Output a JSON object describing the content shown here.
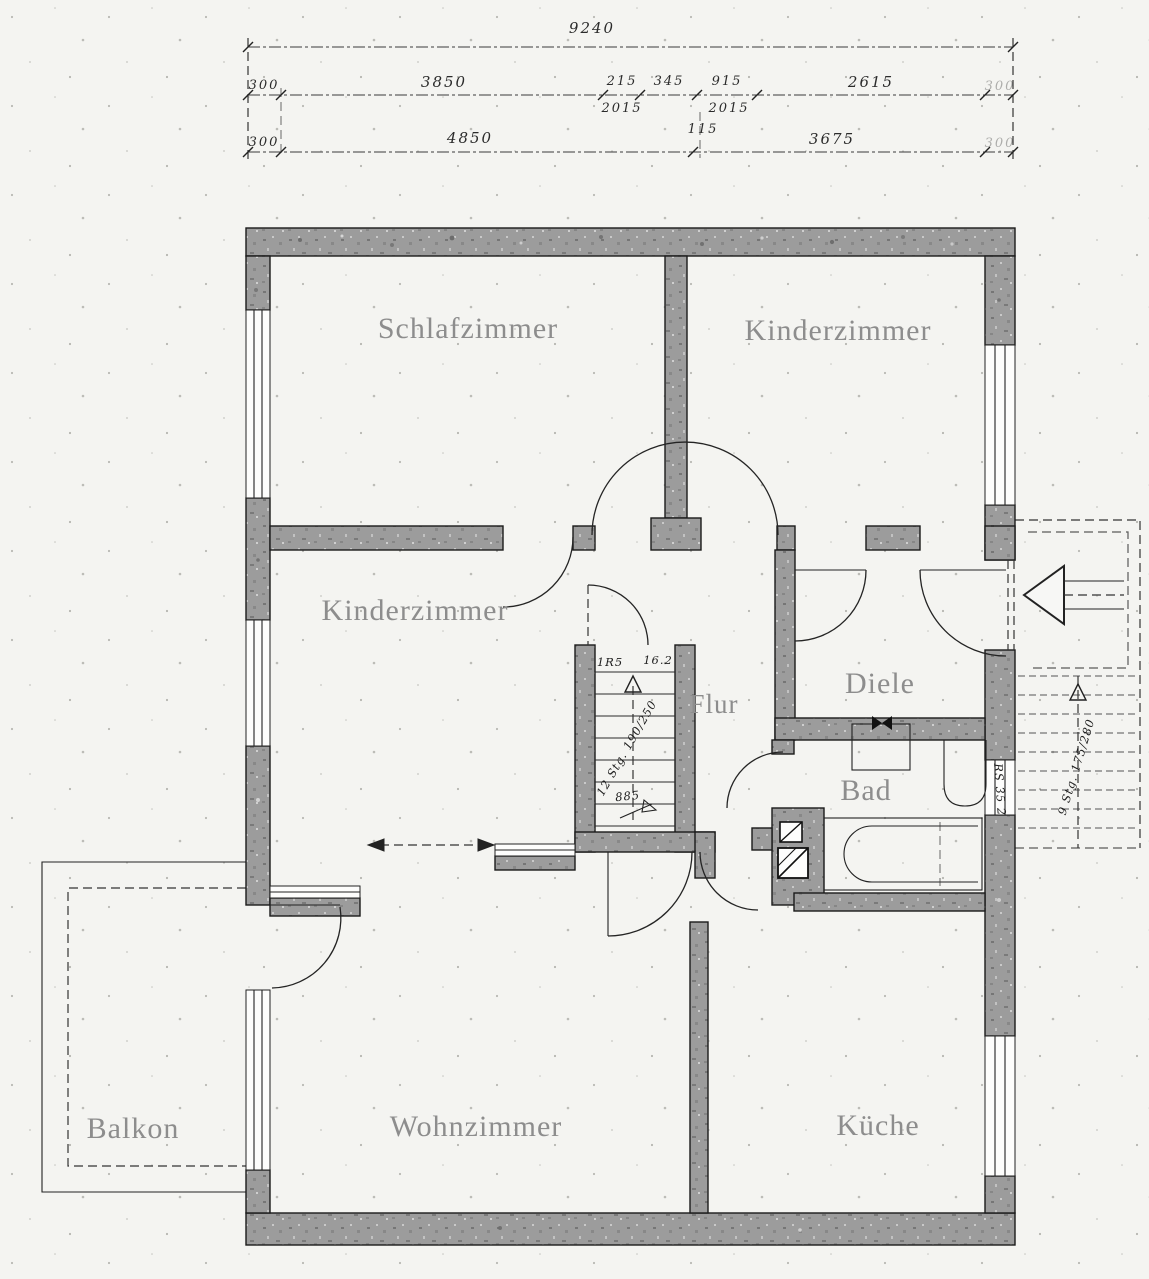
{
  "drawing": {
    "type": "floor-plan",
    "colors": {
      "wall": "#9c9c9c",
      "line": "#1b1b1b",
      "room_label": "#8d8d8d",
      "paper": "#f4f4f1"
    }
  },
  "dims": {
    "total": "9240",
    "a0": "300",
    "a1": "3850",
    "a2": "215",
    "a3": "345",
    "a4": "915",
    "a5": "2615",
    "a_sub0": "2015",
    "a_sub1": "2015",
    "a_mid": "115",
    "a_right": "300",
    "b0": "300",
    "b1": "4850",
    "b2": "3675",
    "b_right": "300"
  },
  "rooms": {
    "schlafzimmer": "Schlafzimmer",
    "kinderzimmer1": "Kinderzimmer",
    "kinderzimmer2": "Kinderzimmer",
    "flur": "Flur",
    "diele": "Diele",
    "bad": "Bad",
    "wohnzimmer": "Wohnzimmer",
    "kueche": "Küche",
    "balkon": "Balkon"
  },
  "stairs": {
    "internal": {
      "label_left": "1R5",
      "label_right": "16.2",
      "steps": "12 Stg. 190/250",
      "width": "885"
    },
    "external": {
      "steps": "9 Stg. 175/280"
    }
  },
  "annotations": {
    "bad_window": "RS 35 2"
  }
}
